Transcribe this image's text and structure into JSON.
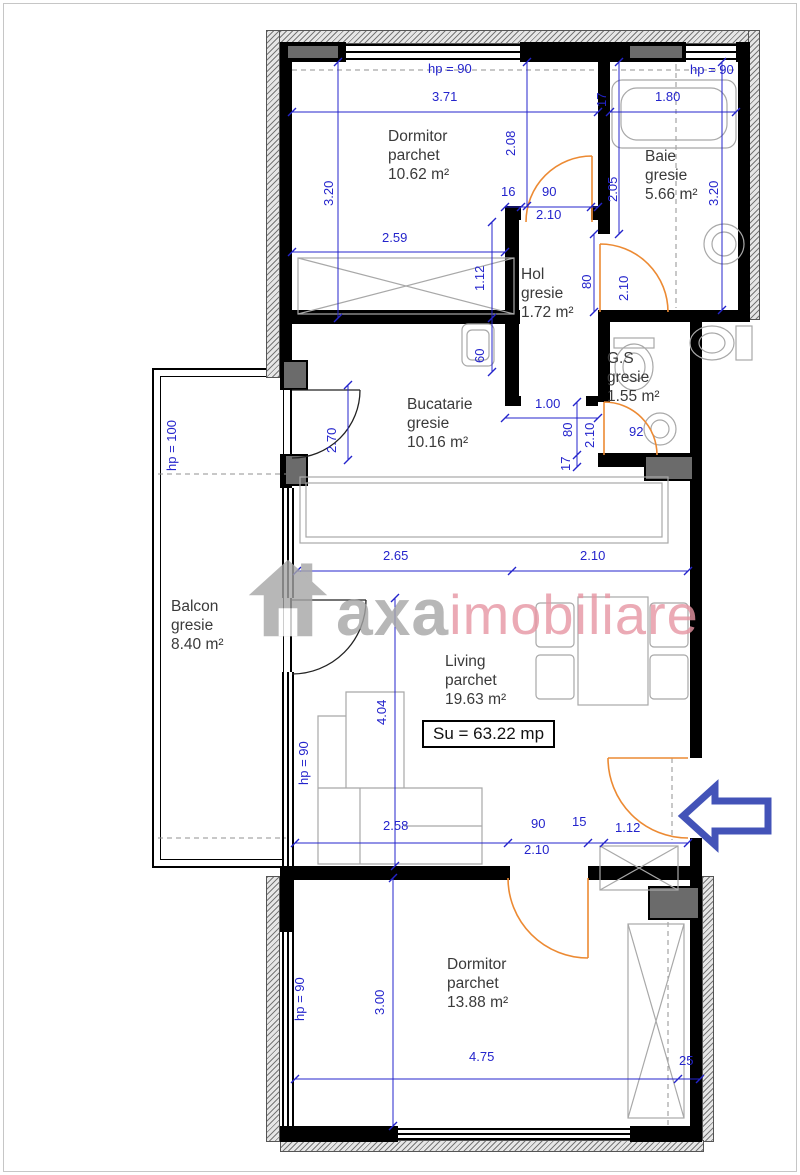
{
  "watermark": {
    "brand_gray": "axa",
    "brand_pink": "imobiliare"
  },
  "total_area_label": "Su = 63.22 mp",
  "rooms": [
    {
      "name": "Dormitor",
      "floor": "parchet",
      "area": "10.62 m²"
    },
    {
      "name": "Baie",
      "floor": "gresie",
      "area": "5.66 m²"
    },
    {
      "name": "Hol",
      "floor": "gresie",
      "area": "1.72 m²"
    },
    {
      "name": "G.S",
      "floor": "gresie",
      "area": "1.55 m²"
    },
    {
      "name": "Bucatarie",
      "floor": "gresie",
      "area": "10.16 m²"
    },
    {
      "name": "Balcon",
      "floor": "gresie",
      "area": "8.40 m²"
    },
    {
      "name": "Living",
      "floor": "parchet",
      "area": "19.63 m²"
    },
    {
      "name": "Dormitor",
      "floor": "parchet",
      "area": "13.88 m²"
    }
  ],
  "dimensions": {
    "hp_top_left": "hp = 90",
    "hp_top_right": "hp = 90",
    "hp_balcony": "hp = 100",
    "hp_living": "hp = 90",
    "hp_bottom": "hp = 90",
    "top_left_width": "3.71",
    "top_right_width": "1.80",
    "wall_17": "17",
    "dormitor1_depth_left": "3.20",
    "dormitor1_depth_right": "2.08",
    "baie_left": "2.05",
    "baie_right": "3.20",
    "dormitor1_width_lower": "2.59",
    "hol_jamb": "16",
    "hol_door_width": "90",
    "hol_door_height": "2.10",
    "wardrobe_depth": "1.12",
    "hol_niche": "60",
    "baie_door_width": "80",
    "baie_door_height": "2.10",
    "hol_opening": "1.00",
    "kitchen_door_height": "2.70",
    "gs_door_width": "80",
    "gs_door_height": "2.10",
    "gs_wall": "17",
    "gs_width": "92",
    "living_width_left": "2.65",
    "living_width_right": "2.10",
    "living_depth": "4.04",
    "sofa_width": "2.58",
    "entry_door_width": "90",
    "entry_jamb": "15",
    "entry_door_height": "2.10",
    "entry_width": "1.12",
    "dormitor2_depth": "3.00",
    "dormitor2_width": "4.75",
    "wall_25": "25"
  },
  "colors": {
    "dimension_blue": "#2424cc",
    "door_orange": "#ec8a33",
    "entrance_arrow_blue": "#4353b8",
    "watermark_gray": "#a6a6a6",
    "watermark_pink": "#e795a3"
  }
}
